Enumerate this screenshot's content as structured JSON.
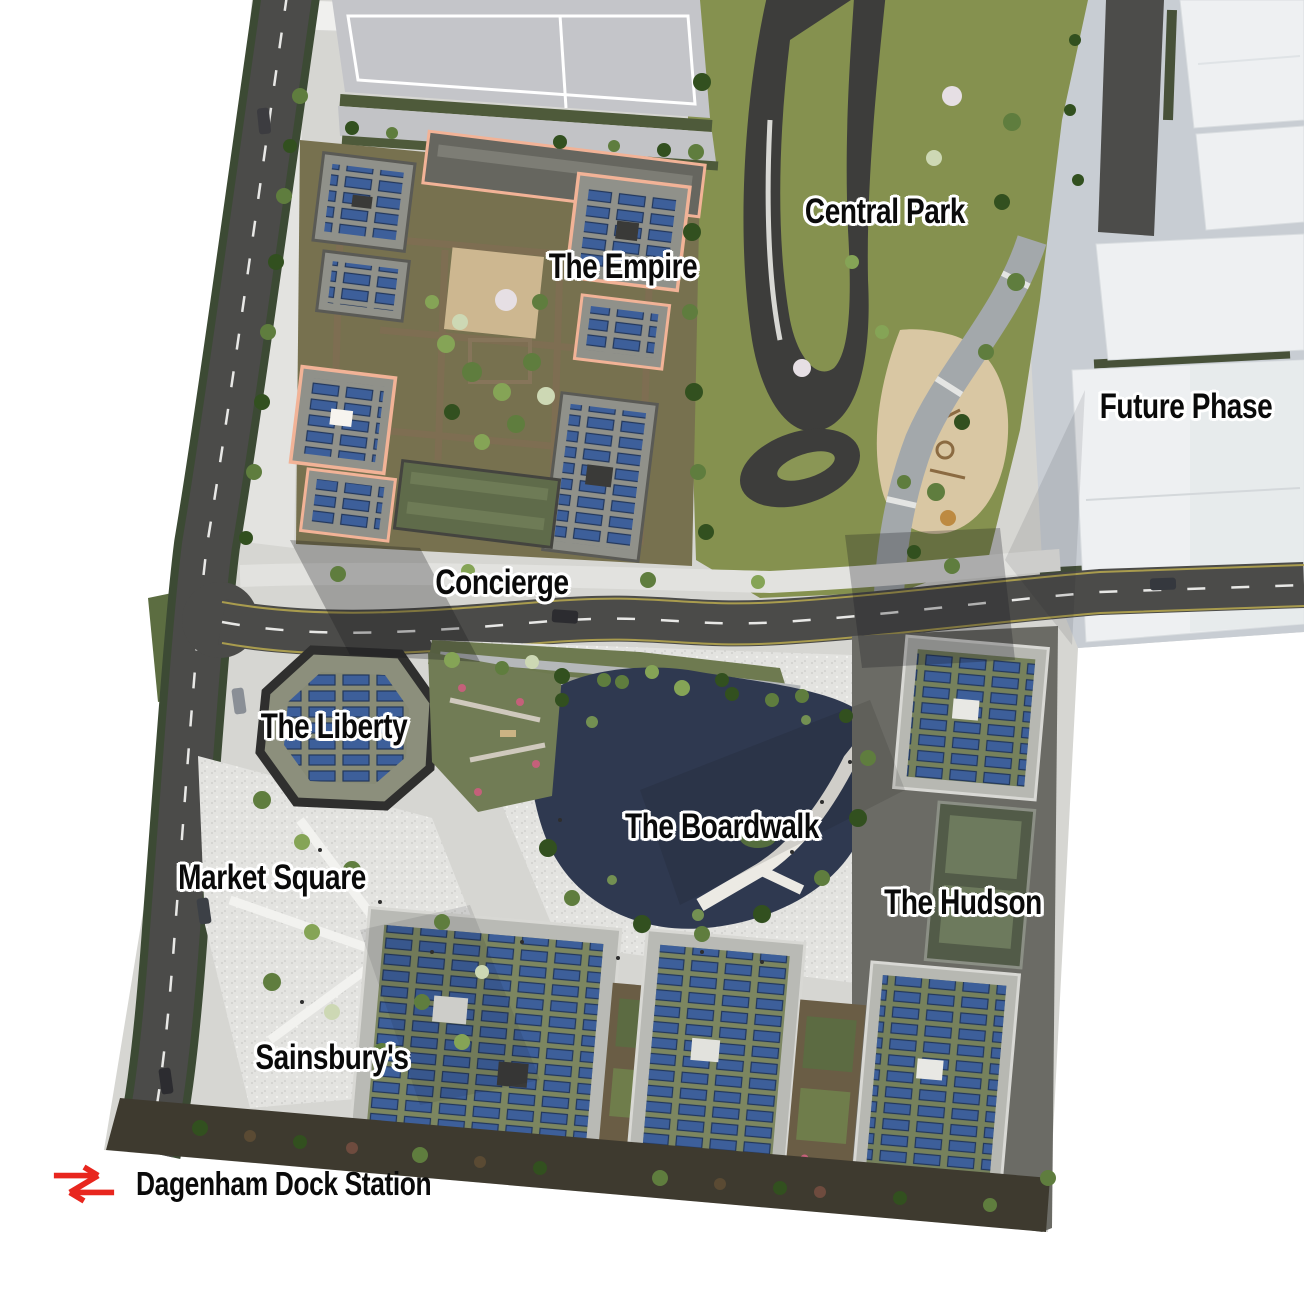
{
  "map": {
    "type": "development-masterplan-aerial",
    "labels": {
      "central_park": "Central Park",
      "the_empire": "The Empire",
      "future_phase": "Future Phase",
      "concierge": "Concierge",
      "the_liberty": "The Liberty",
      "the_boardwalk": "The Boardwalk",
      "market_square": "Market Square",
      "the_hudson": "The Hudson",
      "sainsburys": "Sainsbury's"
    },
    "station": {
      "label": "Dagenham Dock Station",
      "icon": "national-rail-double-arrow",
      "icon_color": "#E8261E"
    },
    "colors": {
      "page_background": "#FFFFFF",
      "label_text": "#0A0A0A",
      "label_outline": "#FFFFFF",
      "road_asphalt": "#4B4B49",
      "park_green": "#85914F",
      "lake_water": "#2F3950",
      "solar_panel_blue": "#3D5F9A",
      "empire_parapet_peach": "#F2B397",
      "future_phase_massing": "#EEF0F2",
      "plaza_paving": "#E3E3E0",
      "rail_red": "#E8261E"
    }
  }
}
